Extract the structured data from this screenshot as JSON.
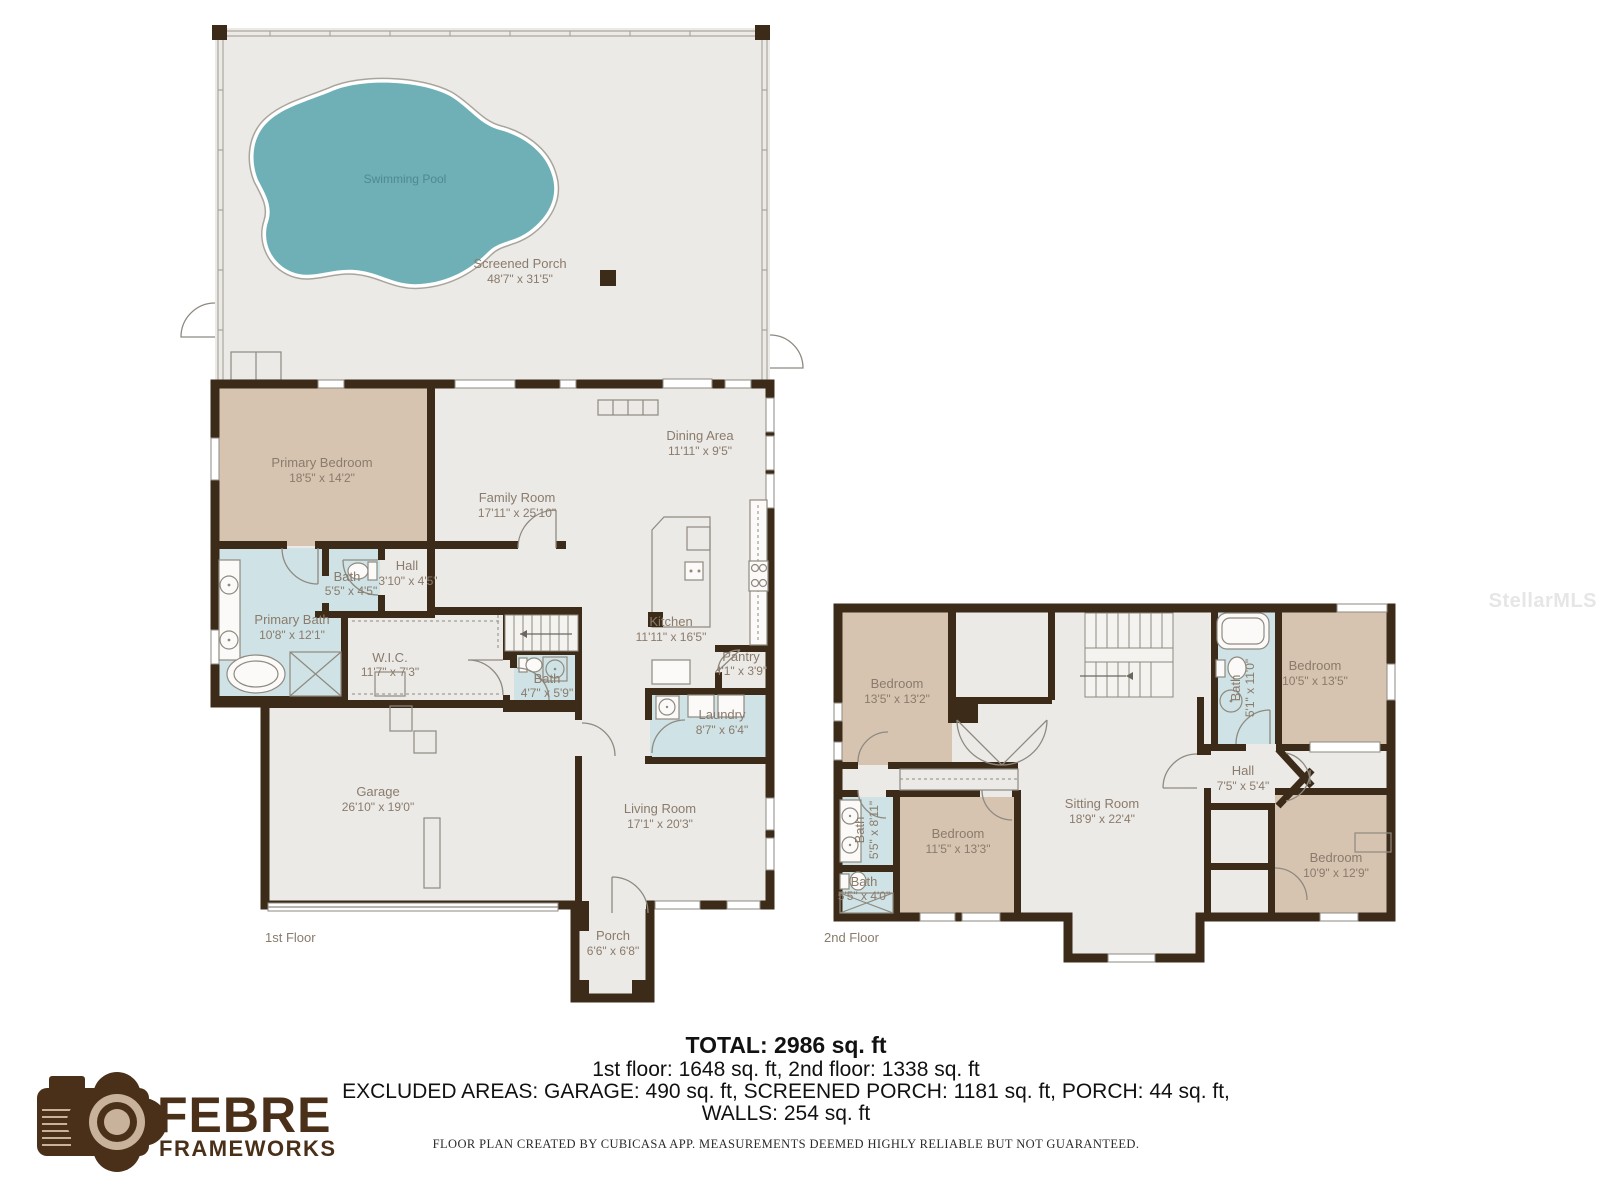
{
  "watermark": "StellarMLS",
  "floor1": {
    "label": "1st Floor",
    "screened_porch": {
      "name": "Screened Porch",
      "dims": "48'7\" x 31'5\""
    },
    "pool": {
      "name": "Swimming Pool"
    },
    "primary_bedroom": {
      "name": "Primary Bedroom",
      "dims": "18'5\" x 14'2\""
    },
    "family_room": {
      "name": "Family Room",
      "dims": "17'11\" x 25'10\""
    },
    "dining_area": {
      "name": "Dining Area",
      "dims": "11'11\" x 9'5\""
    },
    "kitchen": {
      "name": "Kitchen",
      "dims": "11'11\" x 16'5\""
    },
    "pantry": {
      "name": "Pantry",
      "dims": "4'1\" x 3'9\""
    },
    "laundry": {
      "name": "Laundry",
      "dims": "8'7\" x 6'4\""
    },
    "primary_bath": {
      "name": "Primary Bath",
      "dims": "10'8\" x 12'1\""
    },
    "wic": {
      "name": "W.I.C.",
      "dims": "11'7\" x 7'3\""
    },
    "bath_small": {
      "name": "Bath",
      "dims": "5'5\" x 4'5\""
    },
    "hall": {
      "name": "Hall",
      "dims": "3'10\" x 4'5\""
    },
    "bath_stairs": {
      "name": "Bath",
      "dims": "4'7\" x 5'9\""
    },
    "garage": {
      "name": "Garage",
      "dims": "26'10\" x 19'0\""
    },
    "living_room": {
      "name": "Living Room",
      "dims": "17'1\" x 20'3\""
    },
    "porch": {
      "name": "Porch",
      "dims": "6'6\" x 6'8\""
    }
  },
  "floor2": {
    "label": "2nd Floor",
    "bedroom_top_left": {
      "name": "Bedroom",
      "dims": "13'5\" x 13'2\""
    },
    "bath_top": {
      "name": "Bath",
      "dims": "5'1\" x 11'0\""
    },
    "bedroom_top_right": {
      "name": "Bedroom",
      "dims": "10'5\" x 13'5\""
    },
    "hall": {
      "name": "Hall",
      "dims": "7'5\" x 5'4\""
    },
    "bath_left": {
      "name": "Bath",
      "dims": "5'5\" x 8'11\""
    },
    "bath_lower_left": {
      "name": "Bath",
      "dims": "5'5\" x 4'0\""
    },
    "bedroom_mid_left": {
      "name": "Bedroom",
      "dims": "11'5\" x 13'3\""
    },
    "sitting_room": {
      "name": "Sitting Room",
      "dims": "18'9\" x 22'4\""
    },
    "bedroom_bottom_right": {
      "name": "Bedroom",
      "dims": "10'9\" x 12'9\""
    }
  },
  "summary": {
    "total": "TOTAL: 2986 sq. ft",
    "floors": "1st floor: 1648 sq. ft, 2nd floor: 1338 sq. ft",
    "excluded": "EXCLUDED AREAS: GARAGE: 490 sq. ft, SCREENED PORCH: 1181 sq. ft, PORCH: 44 sq. ft,",
    "walls": "WALLS: 254 sq. ft",
    "disclaimer": "FLOOR PLAN CREATED BY CUBICASA APP. MEASUREMENTS DEEMED HIGHLY RELIABLE BUT NOT GUARANTEED."
  },
  "logo": {
    "name": "FEBRE",
    "tagline": "FRAMEWORKS"
  },
  "colors": {
    "wall": "#3C2B19",
    "floor": "#ECEAE6",
    "bedroom_fill": "#D6C4B0",
    "bath_fill": "#CFE2E5",
    "pool_fill": "#6FAFB6",
    "label_text": "#8A7B6C",
    "logo_brown": "#4A3018"
  }
}
